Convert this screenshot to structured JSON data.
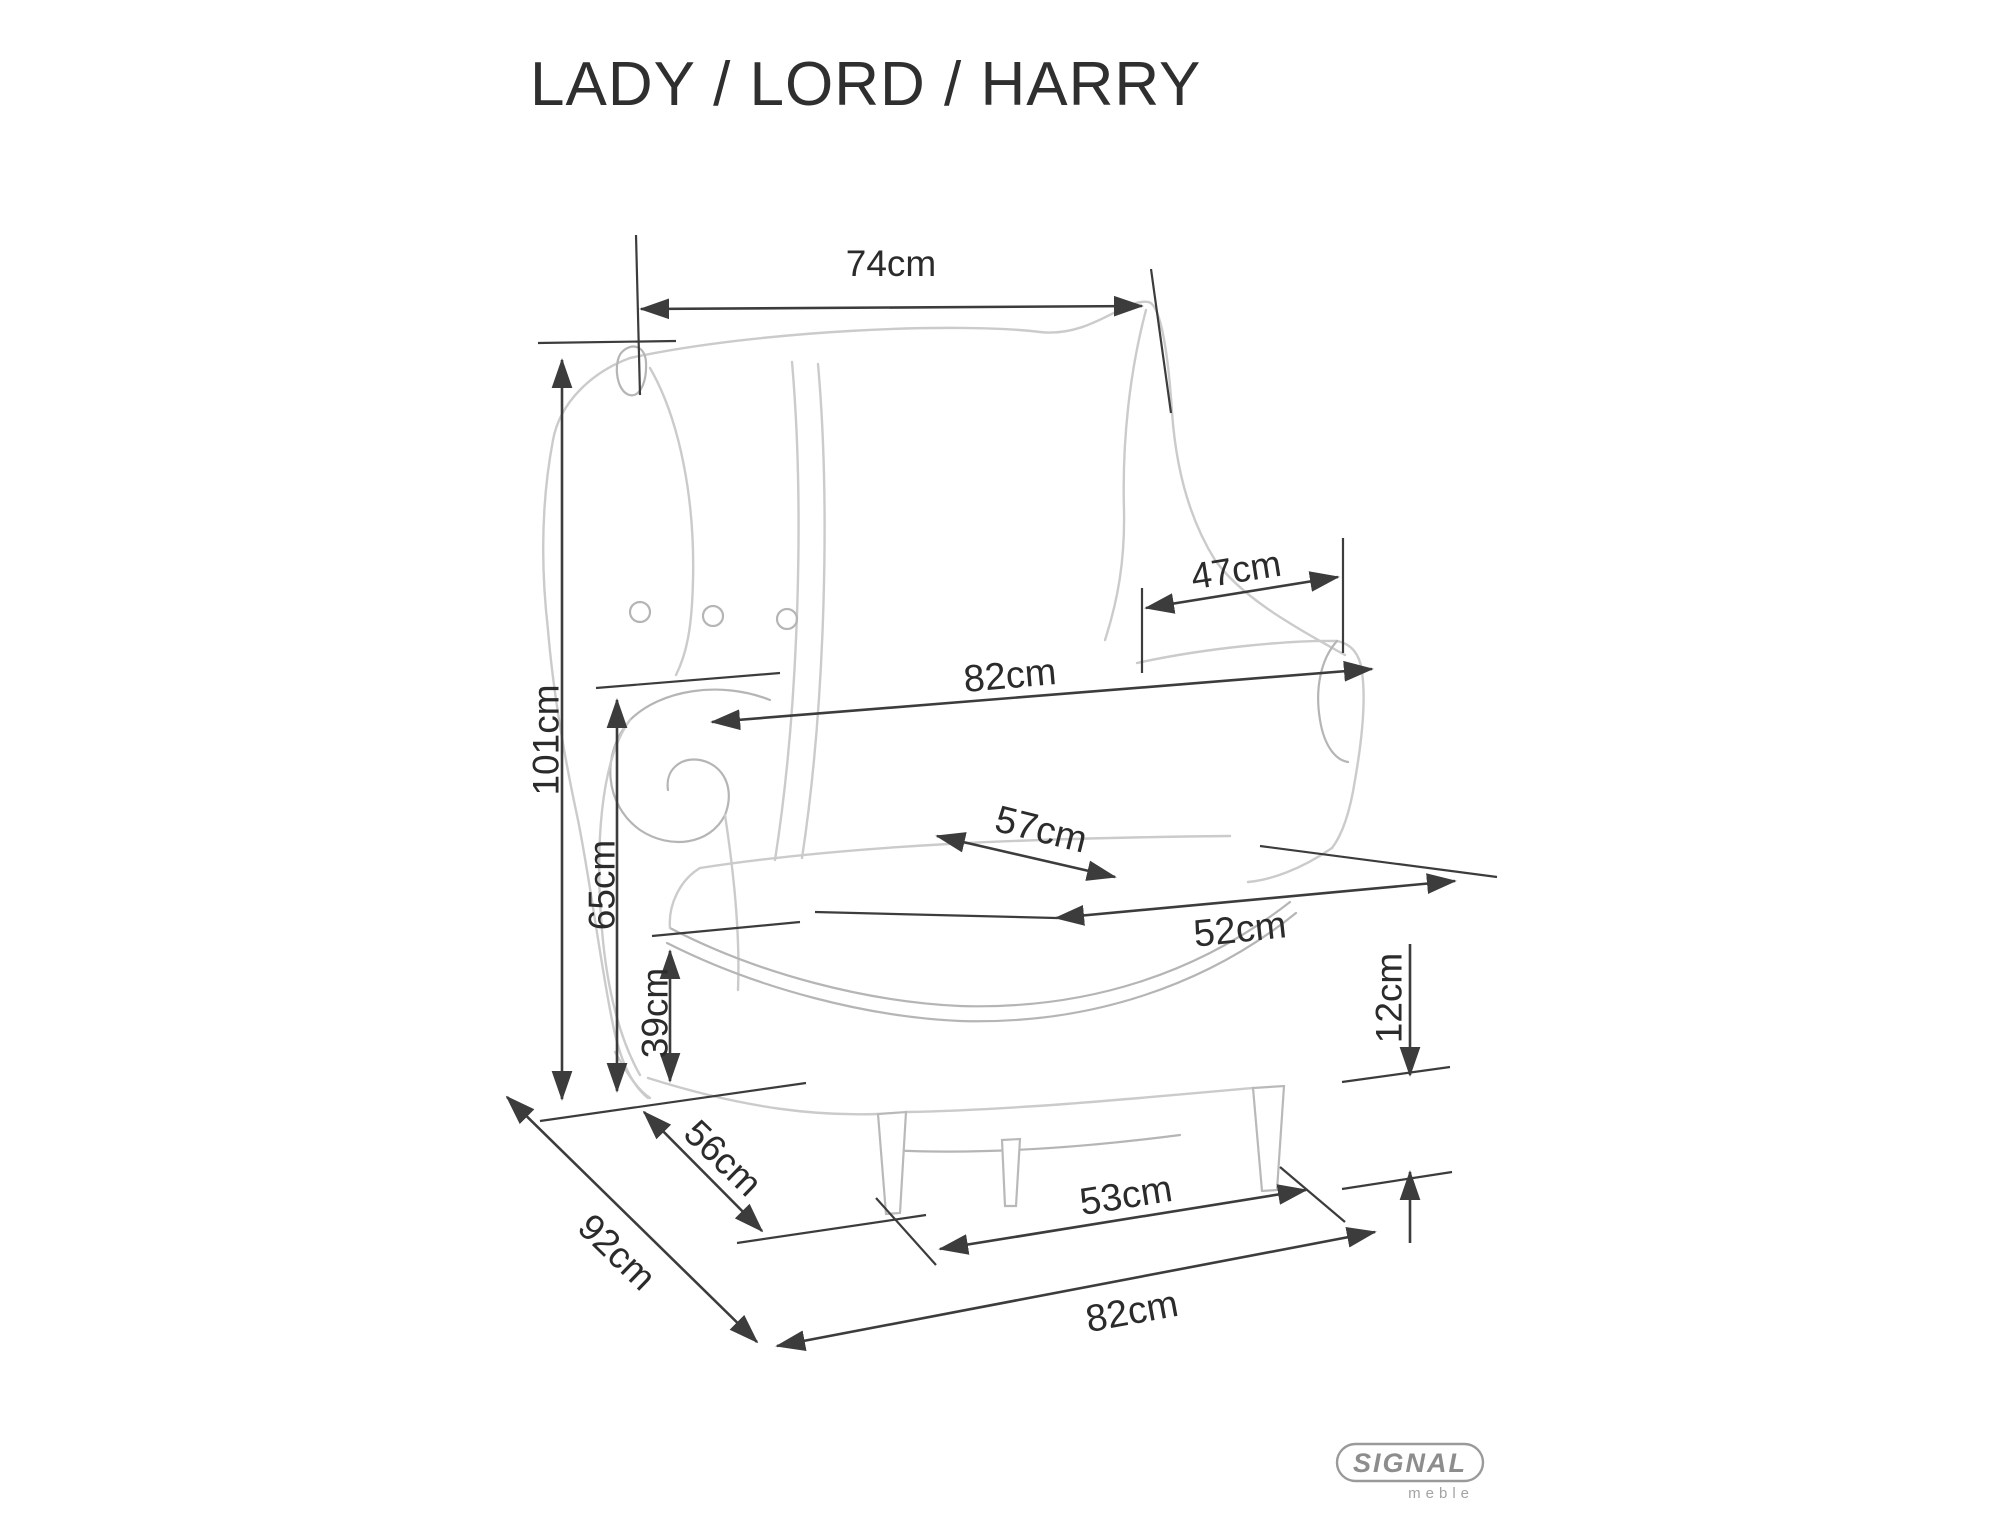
{
  "title": "LADY / LORD / HARRY",
  "brand": {
    "name": "SIGNAL",
    "tagline": "meble"
  },
  "colors": {
    "background": "#ffffff",
    "dimension_lines": "#3c3c3c",
    "label_text": "#2b2b2b",
    "sketch": "#c9c9c9",
    "logo": "#999999"
  },
  "diagram": {
    "subject": "wingback-armchair",
    "unit": "cm"
  },
  "dimensions": [
    {
      "id": "top-width",
      "label": "74cm",
      "value": 74,
      "unit": "cm"
    },
    {
      "id": "overall-height",
      "label": "101cm",
      "value": 101,
      "unit": "cm"
    },
    {
      "id": "between-arms-width",
      "label": "47cm",
      "value": 47,
      "unit": "cm"
    },
    {
      "id": "arm-level-width",
      "label": "82cm",
      "value": 82,
      "unit": "cm"
    },
    {
      "id": "arm-height",
      "label": "65cm",
      "value": 65,
      "unit": "cm"
    },
    {
      "id": "seat-depth",
      "label": "57cm",
      "value": 57,
      "unit": "cm"
    },
    {
      "id": "seat-front-width",
      "label": "52cm",
      "value": 52,
      "unit": "cm"
    },
    {
      "id": "seat-height",
      "label": "39cm",
      "value": 39,
      "unit": "cm"
    },
    {
      "id": "leg-height",
      "label": "12cm",
      "value": 12,
      "unit": "cm"
    },
    {
      "id": "base-depth",
      "label": "56cm",
      "value": 56,
      "unit": "cm"
    },
    {
      "id": "overall-depth",
      "label": "92cm",
      "value": 92,
      "unit": "cm"
    },
    {
      "id": "front-leg-span",
      "label": "53cm",
      "value": 53,
      "unit": "cm"
    },
    {
      "id": "overall-width",
      "label": "82cm",
      "value": 82,
      "unit": "cm"
    }
  ]
}
